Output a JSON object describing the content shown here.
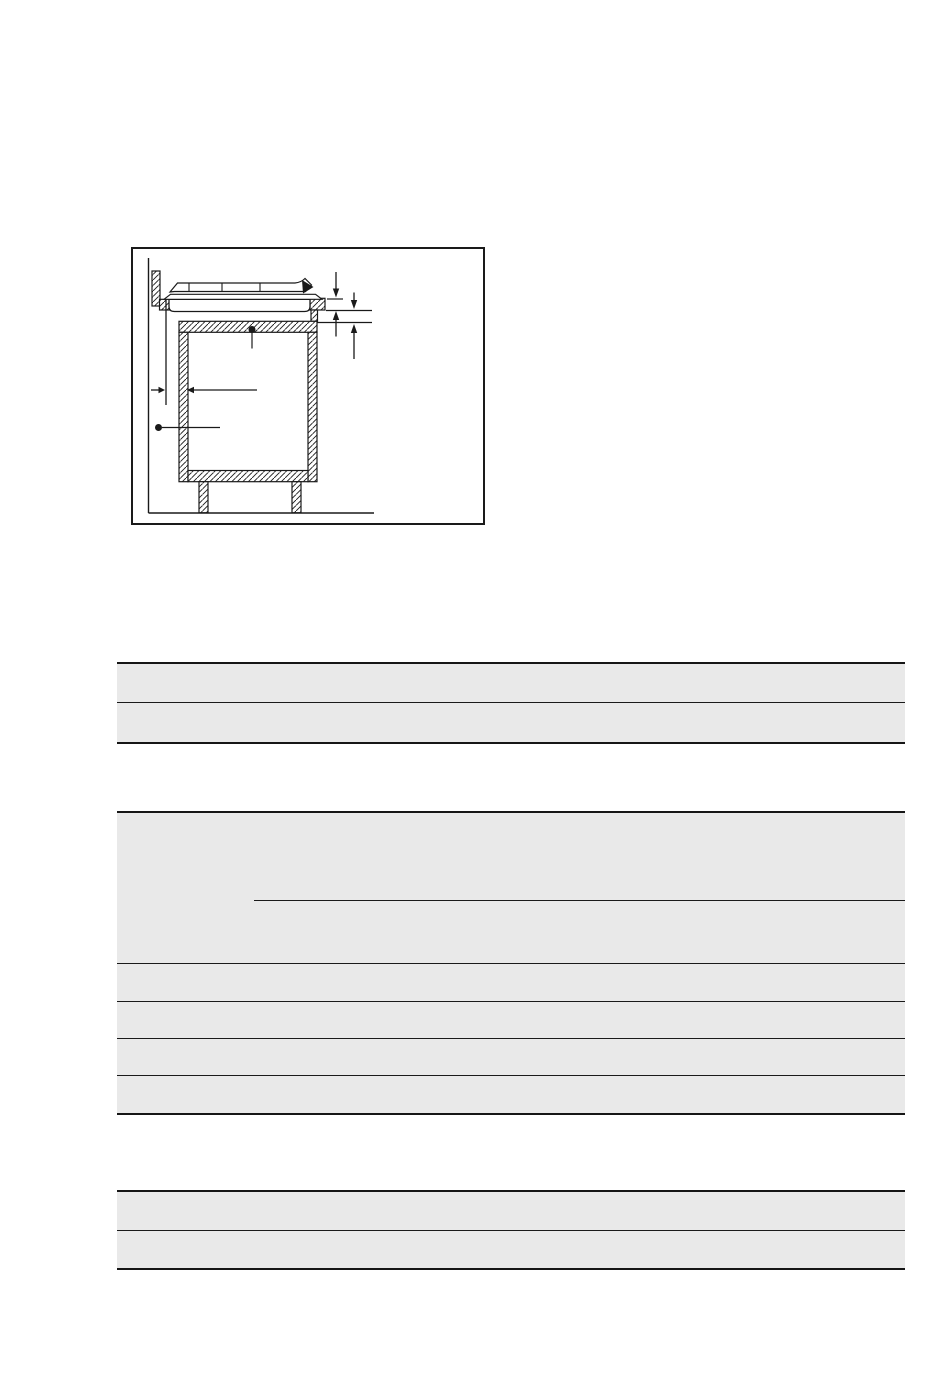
{
  "page": {
    "background": "#ffffff"
  },
  "colors": {
    "line": "#1a1a1a",
    "table_border": "#161616",
    "table_row_fill": "#e9e9e9",
    "figure_fill": "#ffffff"
  },
  "figure": {
    "subject": "built-in-hob-installation-cross-section",
    "callouts": [
      "cabinet-top-panel-dot",
      "cabinet-side-dot"
    ],
    "dimension_markers": [
      "worktop-thickness",
      "clearance-below-worktop",
      "side-wall-clearance"
    ]
  },
  "tables": [
    {
      "id": "table-top",
      "rows": [
        "",
        ""
      ]
    },
    {
      "id": "table-middle",
      "rows": [
        "",
        "",
        "",
        "",
        ""
      ],
      "first_row_has_partial_divider": true
    },
    {
      "id": "table-bottom",
      "rows": [
        "",
        ""
      ]
    }
  ]
}
